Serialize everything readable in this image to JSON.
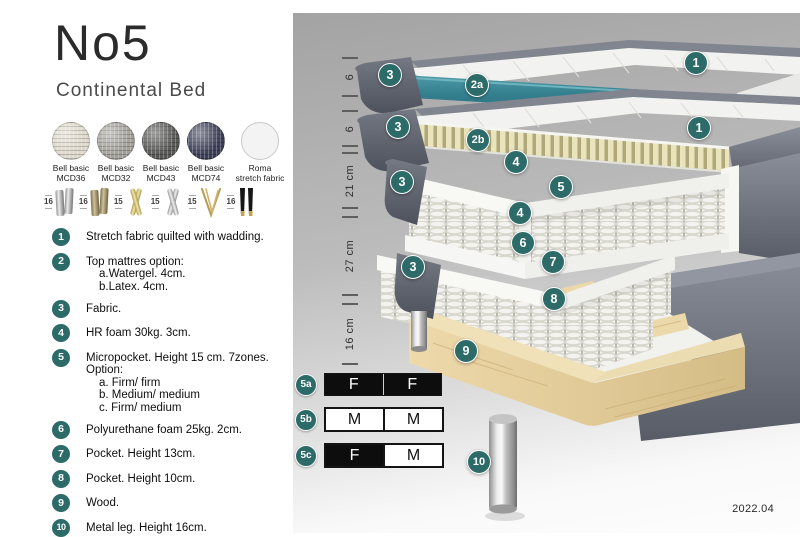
{
  "header": {
    "title": "No5",
    "subtitle": "Continental Bed"
  },
  "fabric_options": [
    {
      "line1": "Bell basic",
      "line2": "MCD36",
      "color": "#ded9cd"
    },
    {
      "line1": "Bell basic",
      "line2": "MCD32",
      "color": "#a3a099"
    },
    {
      "line1": "Bell basic",
      "line2": "MCD43",
      "color": "#585856"
    },
    {
      "line1": "Bell basic",
      "line2": "MCD74",
      "color": "#3b3f58"
    },
    {
      "line1": "Roma",
      "line2": "stretch fabric",
      "color": "#f3f3f3"
    }
  ],
  "leg_options": [
    {
      "height": "16",
      "type": "chrome-cylinder-legs"
    },
    {
      "height": "16",
      "type": "bronze-cylinder-legs"
    },
    {
      "height": "15",
      "type": "gold-cross-legs"
    },
    {
      "height": "15",
      "type": "silver-cross-legs"
    },
    {
      "height": "15",
      "type": "hairpin-legs"
    },
    {
      "height": "16",
      "type": "black-brass-legs"
    }
  ],
  "features": [
    {
      "num": "1",
      "text": "Stretch fabric quilted with wadding."
    },
    {
      "num": "2",
      "text": "Top mattres option:",
      "sub": [
        "a.Watergel. 4cm.",
        "b.Latex. 4cm."
      ]
    },
    {
      "num": "3",
      "text": "Fabric."
    },
    {
      "num": "4",
      "text": "HR foam 30kg. 3cm."
    },
    {
      "num": "5",
      "text": "Micropocket. Height 15 cm. 7zones. Option:",
      "sub": [
        "a. Firm/ firm",
        "b. Medium/ medium",
        "c. Firm/ medium"
      ]
    },
    {
      "num": "6",
      "text": "Polyurethane foam 25kg. 2cm."
    },
    {
      "num": "7",
      "text": "Pocket. Height 13cm."
    },
    {
      "num": "8",
      "text": "Pocket. Height 10cm."
    },
    {
      "num": "9",
      "text": "Wood."
    },
    {
      "num": "10",
      "text": "Metal leg. Height 16cm."
    }
  ],
  "diagram": {
    "measurements": [
      "6",
      "6",
      "21 cm",
      "27 cm",
      "16 cm"
    ],
    "callouts": [
      "1",
      "3",
      "2a",
      "3",
      "2b",
      "1",
      "4",
      "5",
      "3",
      "4",
      "6",
      "7",
      "3",
      "8",
      "9",
      "10"
    ],
    "firmness_table": [
      {
        "label": "5a",
        "cells": [
          {
            "text": "F",
            "style": "dark"
          },
          {
            "text": "F",
            "style": "dark"
          }
        ]
      },
      {
        "label": "5b",
        "cells": [
          {
            "text": "M",
            "style": "light"
          },
          {
            "text": "M",
            "style": "light"
          }
        ]
      },
      {
        "label": "5c",
        "cells": [
          {
            "text": "F",
            "style": "dark"
          },
          {
            "text": "M",
            "style": "light"
          }
        ]
      }
    ],
    "version": "2022.04"
  },
  "colors": {
    "accent_teal": "#2d6b69",
    "topper_teal": "#35808f",
    "fabric_gray": "#6e727c",
    "latex_cream": "#eae4bc",
    "wood": "#e8d2a4"
  }
}
